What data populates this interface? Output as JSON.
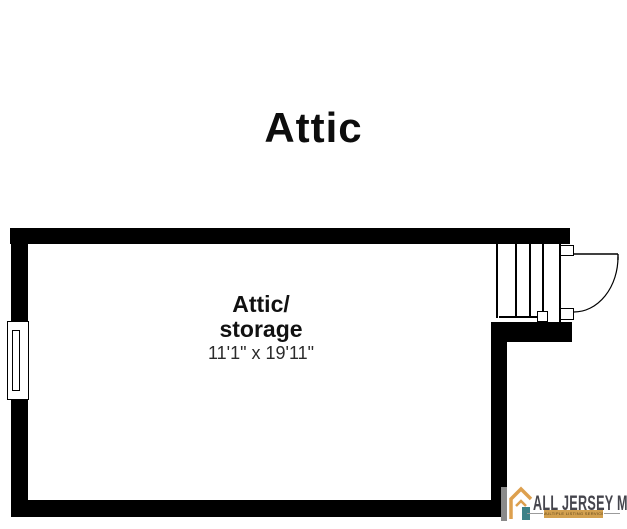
{
  "title": "Attic",
  "room": {
    "name_line1": "Attic/",
    "name_line2": "storage",
    "dimensions": "11'1\" x 19'11\""
  },
  "logo": {
    "brand": "ALL JERSEY MLS",
    "tagline": "MULTIPLE LISTING SERVICE"
  },
  "colors": {
    "wall": "#000000",
    "background": "#ffffff",
    "logo_text": "#45454d",
    "logo_orange": "#dda04e",
    "logo_teal": "#3d8187",
    "logo_gray_bar": "#8a8a8a",
    "tagline_bar": "#d2a04f"
  }
}
